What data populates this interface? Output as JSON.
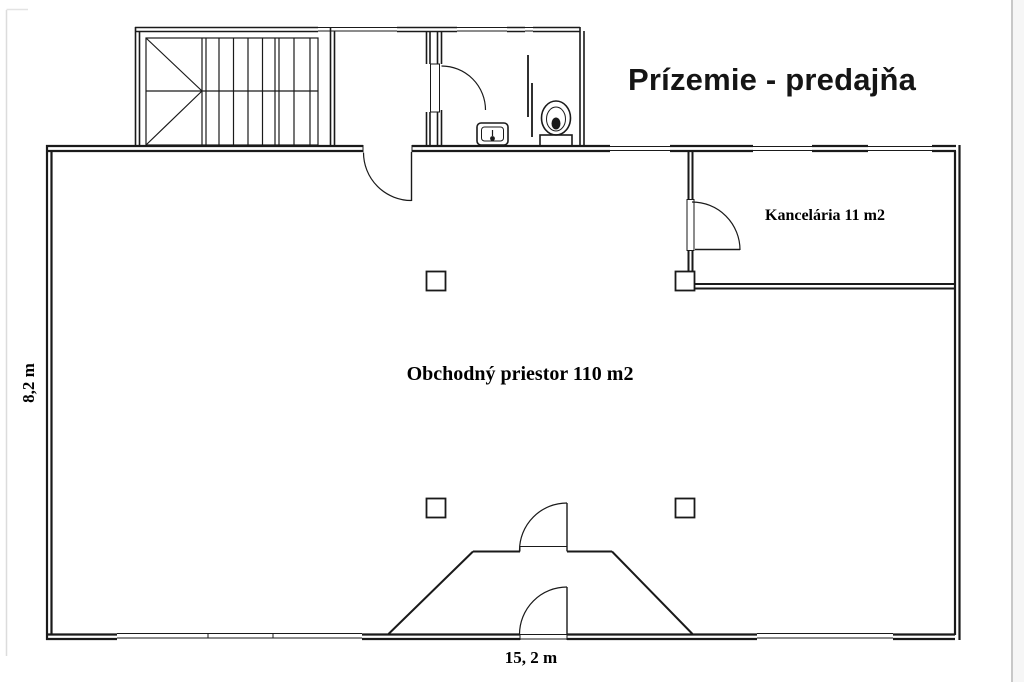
{
  "title": "Prízemie - predajňa",
  "rooms": {
    "main_room_label": "Obchodný priestor 110 m2",
    "office_label": "Kancelária 11 m2"
  },
  "dimensions": {
    "width_label": "15, 2 m",
    "height_label": "8,2 m"
  },
  "colors": {
    "wall_line": "#1a1a1a",
    "text": "#000000",
    "page_edge": "#c8c8c8",
    "background": "#ffffff"
  }
}
